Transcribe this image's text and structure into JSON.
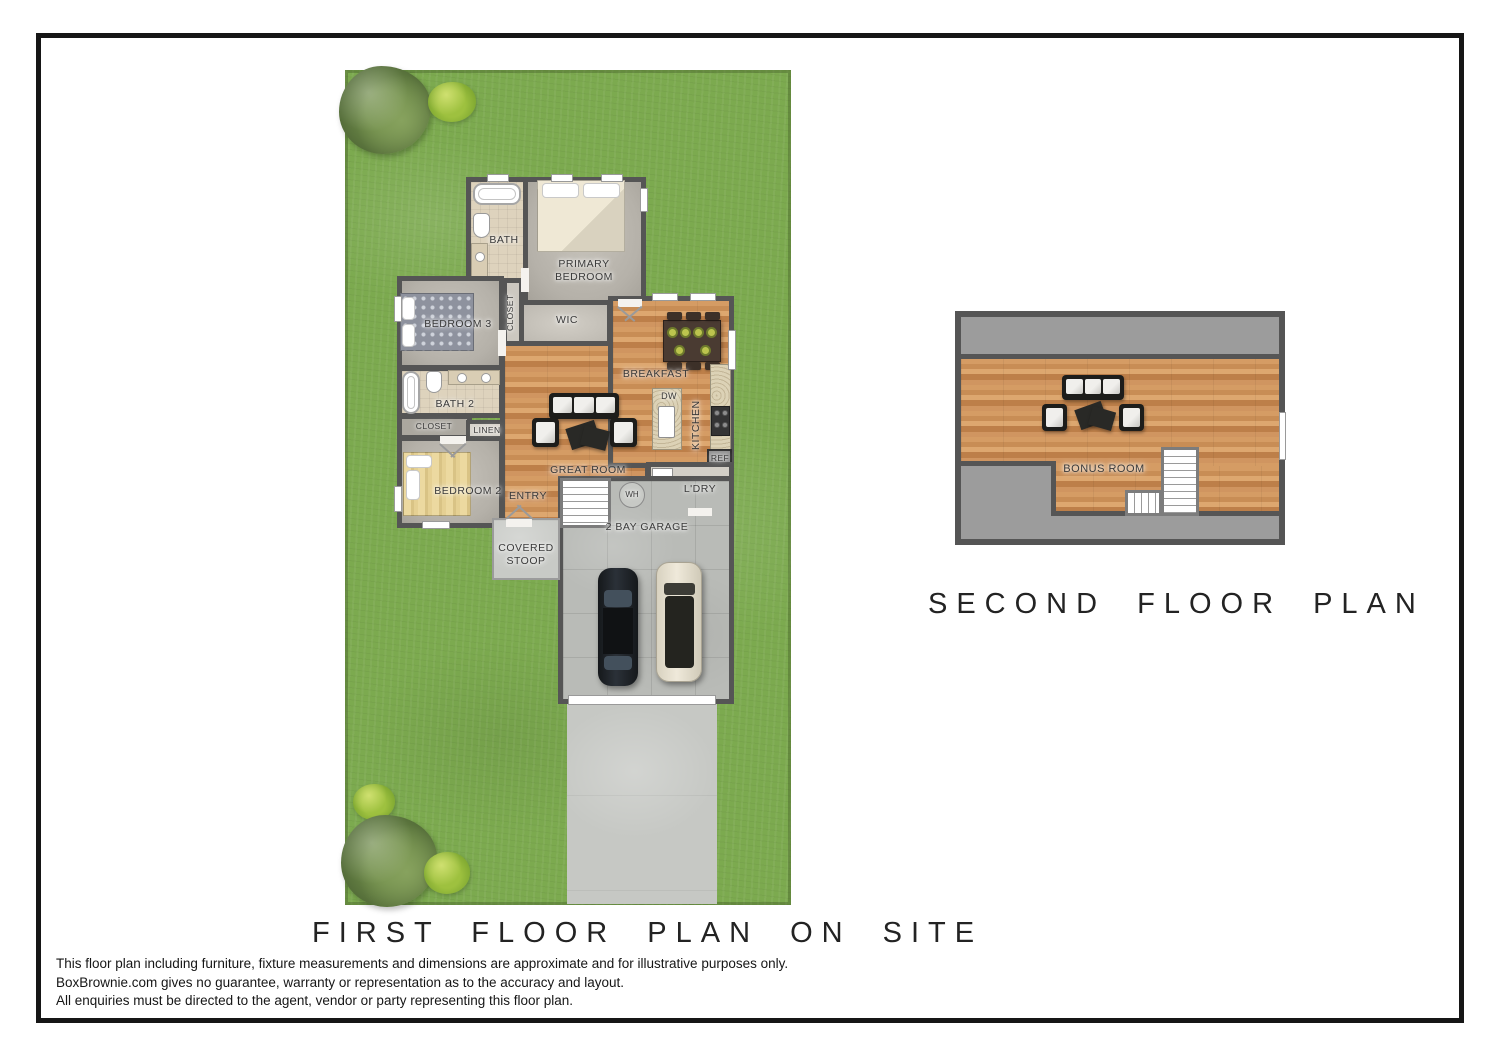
{
  "titles": {
    "first_floor": "FIRST FLOOR PLAN ON SITE",
    "second_floor": "SECOND FLOOR PLAN"
  },
  "disclaimer": {
    "line1": "This floor plan including furniture, fixture measurements and dimensions are approximate and for illustrative purposes only.",
    "line2": "BoxBrownie.com gives no guarantee, warranty or representation as to the accuracy and layout.",
    "line3": "All enquiries must be directed to the agent, vendor or party representing this floor plan."
  },
  "first_floor": {
    "rooms": {
      "bath": "BATH",
      "primary_bedroom": "PRIMARY BEDROOM",
      "closet_vertical": "CLOSET",
      "wic": "WIC",
      "bedroom3": "BEDROOM 3",
      "breakfast": "BREAKFAST",
      "dw": "DW",
      "kitchen": "KITCHEN",
      "ref": "REF",
      "bath2": "BATH 2",
      "closet": "CLOSET",
      "linen": "LINEN",
      "bedroom2": "BEDROOM 2",
      "great_room": "GREAT ROOM",
      "entry": "ENTRY",
      "ldry": "L'DRY",
      "wh": "WH",
      "garage": "2 BAY GARAGE",
      "covered_stoop": "COVERED STOOP"
    }
  },
  "second_floor": {
    "rooms": {
      "bonus_room": "BONUS ROOM"
    }
  },
  "colors": {
    "frame": "#161616",
    "grass": "#7caa4f",
    "wall": "#555555",
    "carpet": "#b5b1a9",
    "tile": "#ded3bd",
    "wood": "#cd9258",
    "concrete": "#b9bbb7",
    "upper_gray": "#9c9c9c"
  }
}
